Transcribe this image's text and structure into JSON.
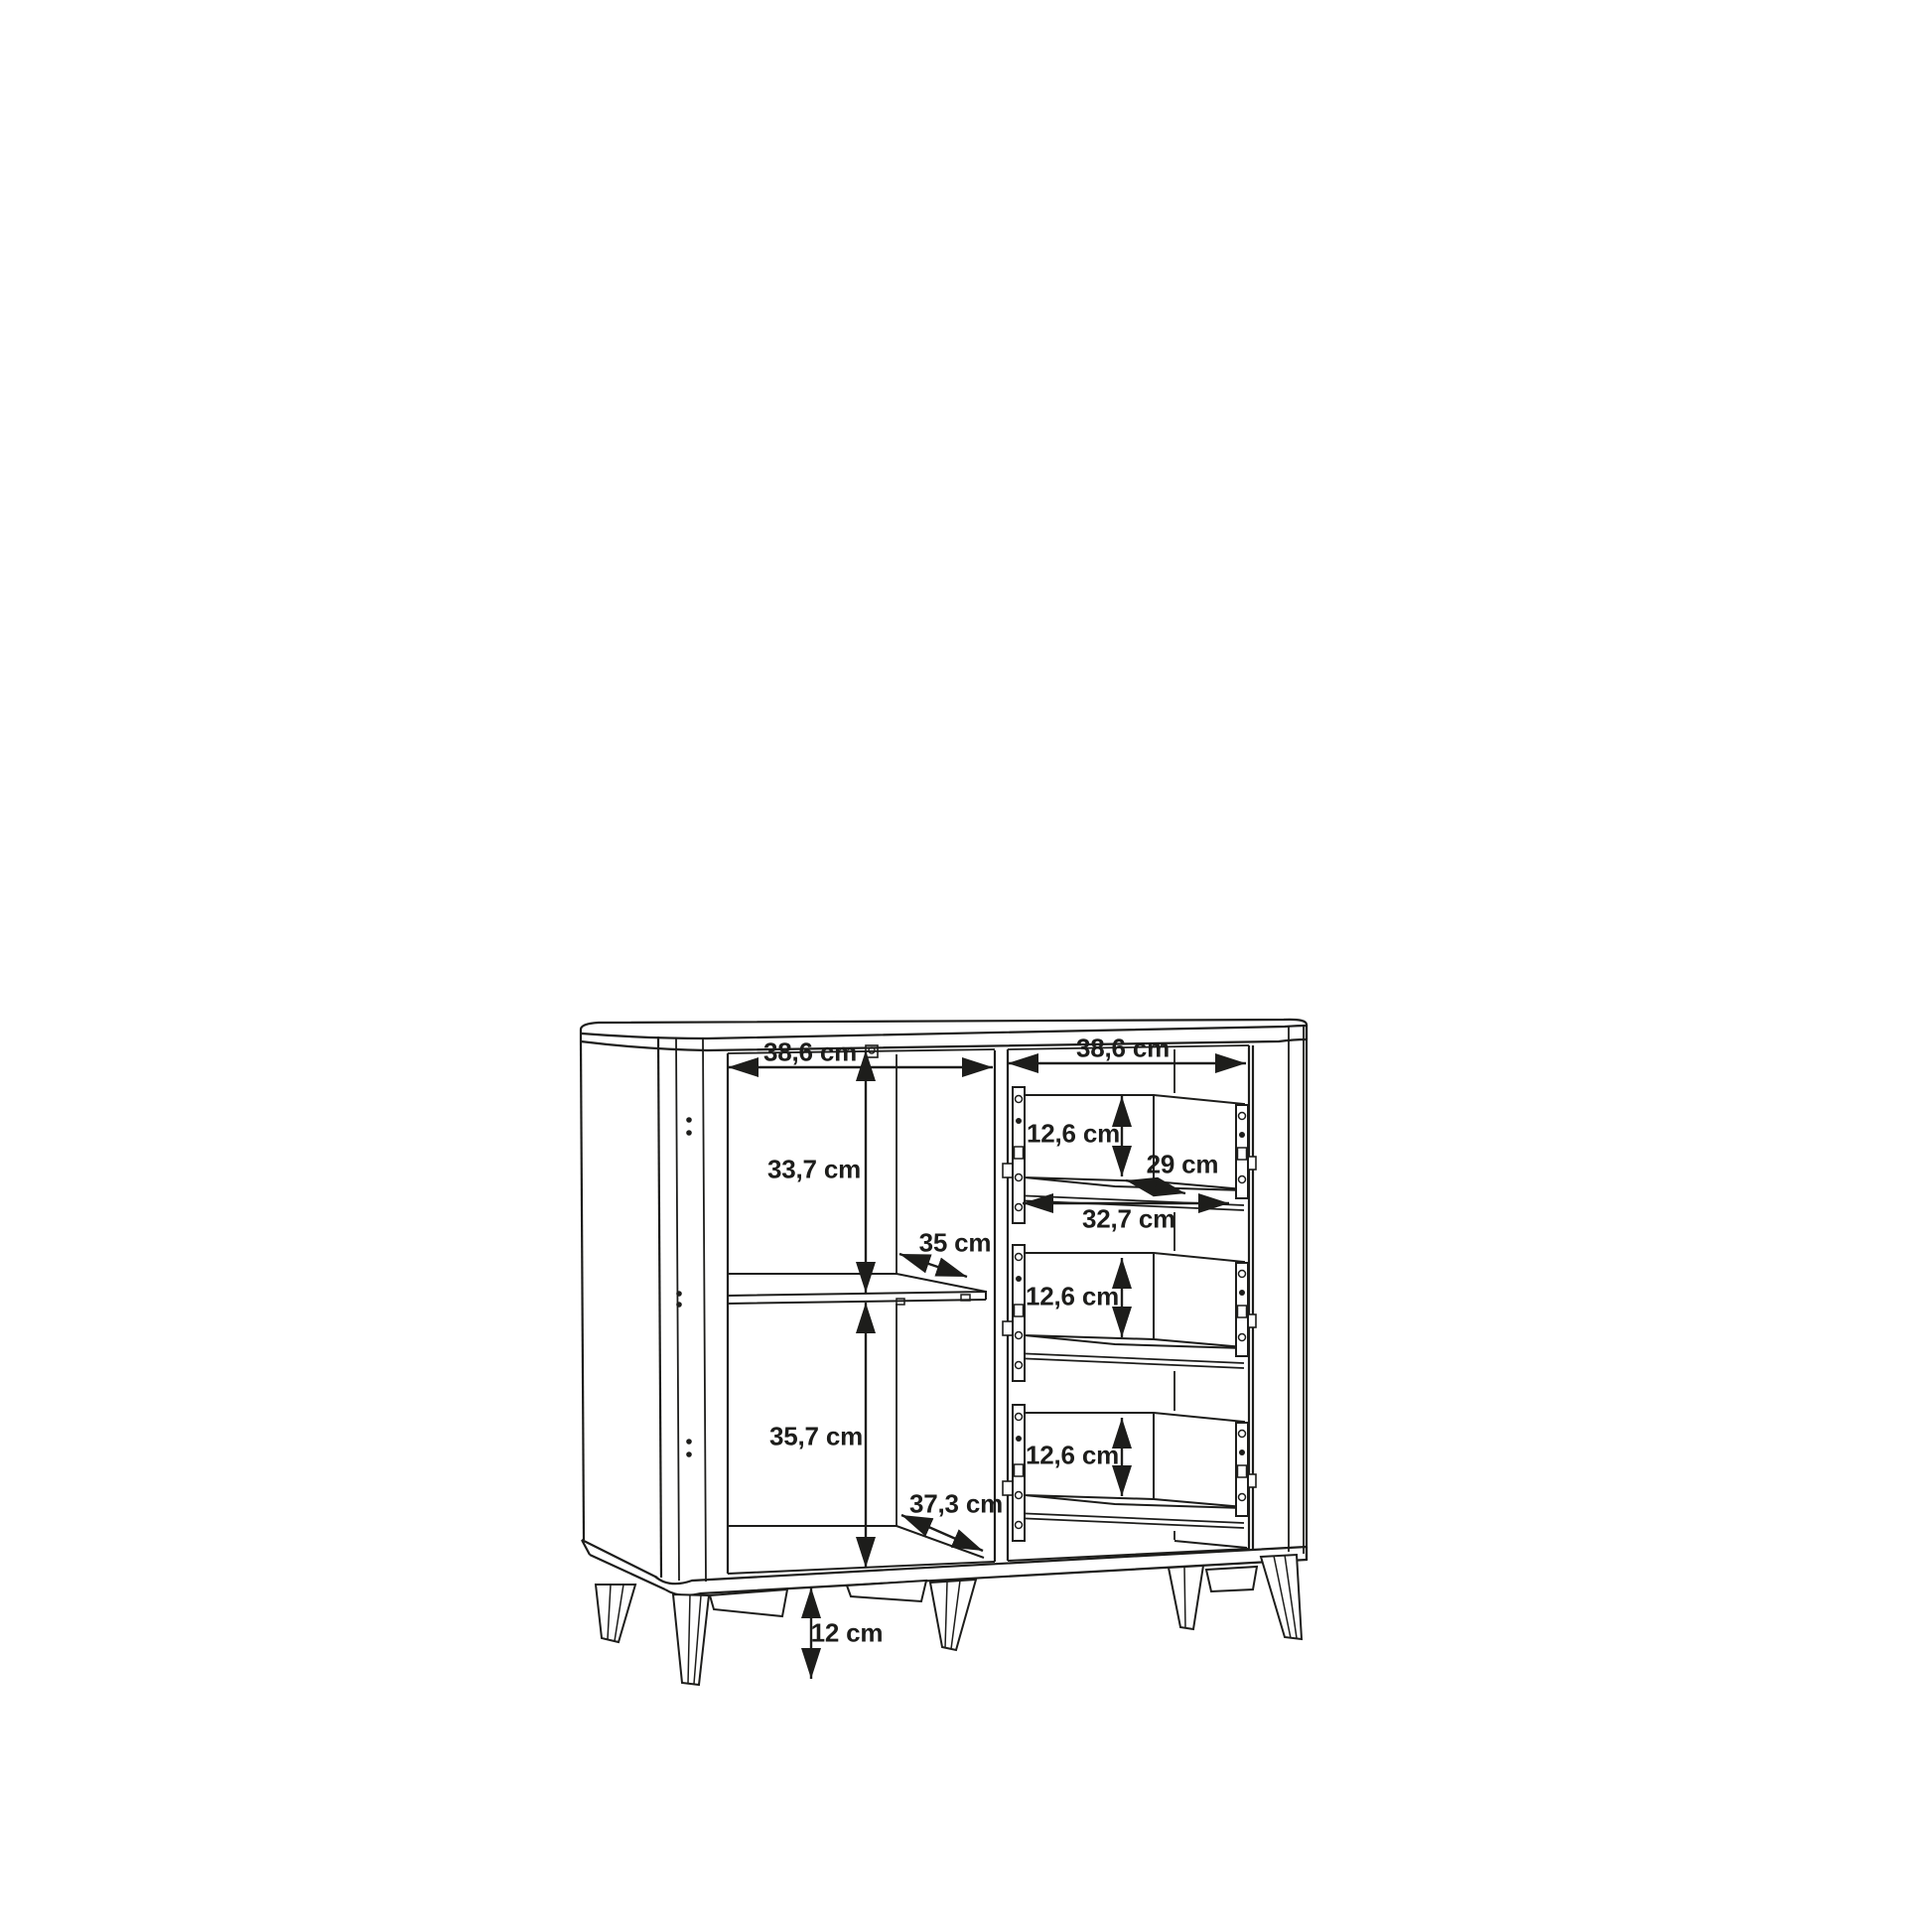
{
  "page": {
    "background": "#ffffff",
    "line_color": "#1d1d1b"
  },
  "diagram": {
    "type": "furniture-dimension-drawing",
    "subject": "sideboard with open left compartment, middle shelf and three drawers on tapered legs",
    "unit": "cm",
    "labels": {
      "left_section_width": "38,6 cm",
      "right_section_width": "38,6 cm",
      "left_upper_height": "33,7 cm",
      "shelf_depth": "35 cm",
      "left_lower_height": "35,7 cm",
      "base_depth": "37,3 cm",
      "drawer_top_height": "12,6 cm",
      "drawer_depth": "29 cm",
      "drawer_width": "32,7 cm",
      "drawer_middle_height": "12,6 cm",
      "drawer_bottom_height": "12,6 cm",
      "leg_height": "12 cm"
    }
  }
}
